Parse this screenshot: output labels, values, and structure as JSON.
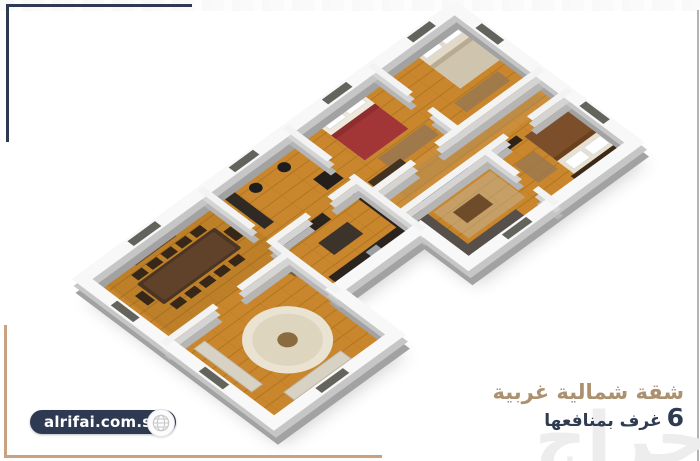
{
  "branding": {
    "website_label": "alrifai.com.sa",
    "globe_icon": "globe-icon"
  },
  "caption": {
    "title": "شقة شمالية غربية",
    "rooms_count": "6",
    "rooms_label": "غرف بمنافعها"
  },
  "watermark": {
    "logo_text": "حراج"
  },
  "colors": {
    "navy": "#2e3a52",
    "tan_text": "#ab9170",
    "tan_border": "#c9a284",
    "wood_floor": "#c9862c",
    "wall_white": "#f6f6f6",
    "wall_side_gray": "#a2a2a2"
  },
  "floorplan": {
    "view": "3d-isometric-apartment-floor-plan",
    "rooms": [
      "dining-room",
      "living-room",
      "kitchen",
      "office",
      "master-bedroom",
      "bedroom",
      "hallway",
      "sitting-room",
      "bedroom-2"
    ]
  }
}
